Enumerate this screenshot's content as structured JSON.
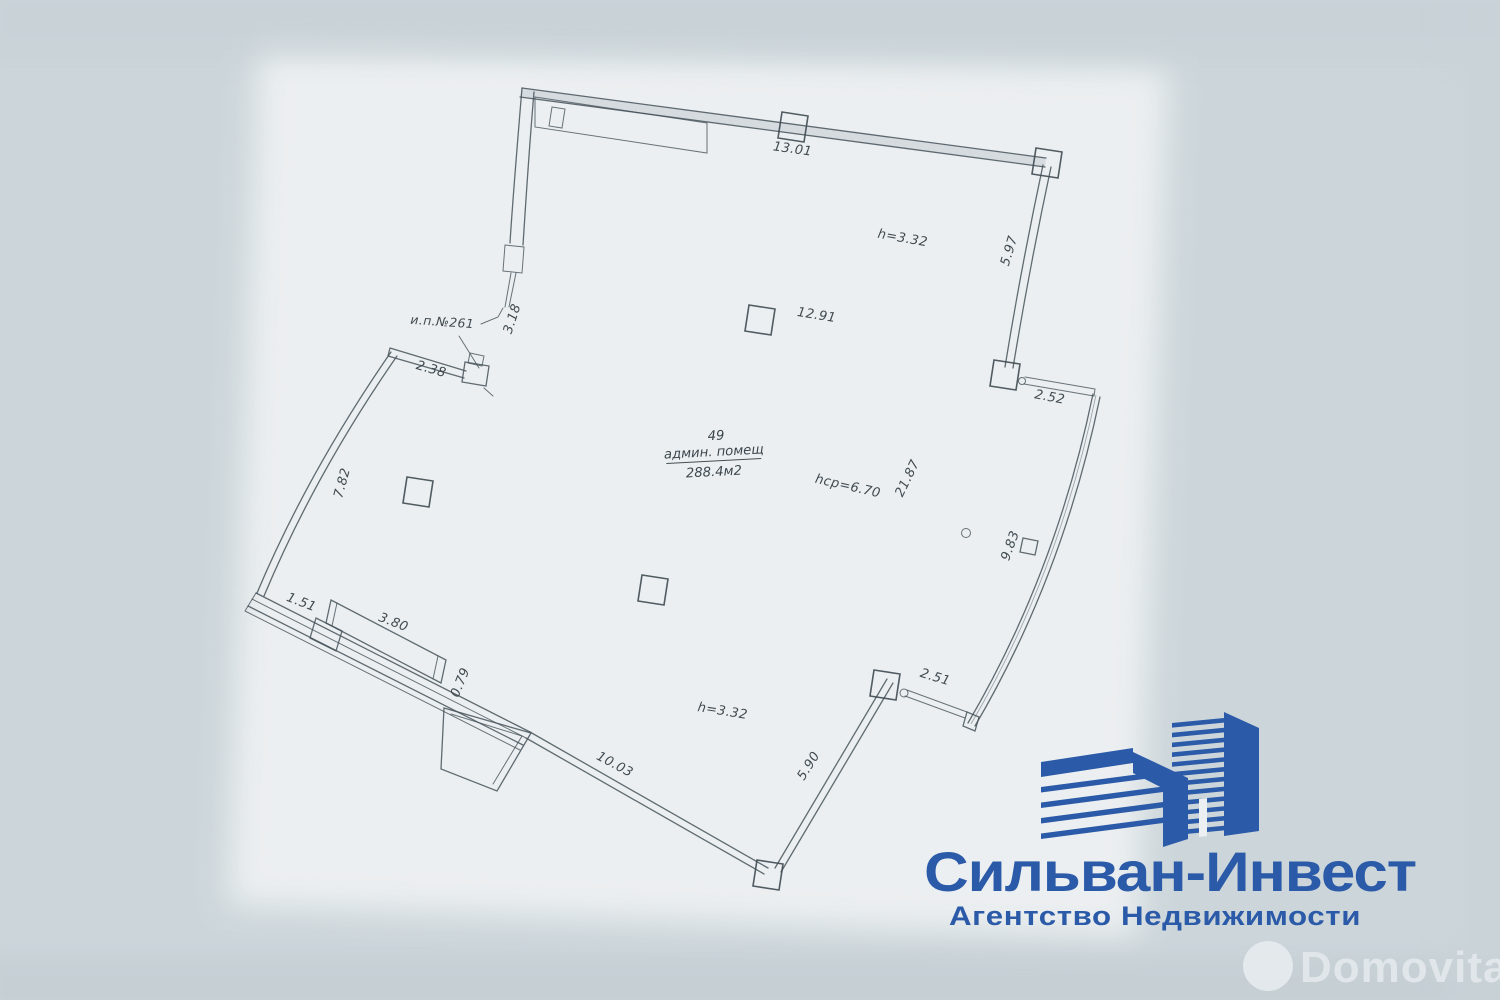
{
  "document_type": "floor-plan-photo",
  "colors": {
    "page_background": "#ccd6da",
    "paper": "#edf0f2",
    "ink": "#46525a",
    "brand_blue": "#2b5aa8",
    "watermark": "#e3e9ec"
  },
  "plan": {
    "unit_pointer": "и.п.№261",
    "room": {
      "number": "49",
      "type": "админ. помещ",
      "area": "288.4м2"
    },
    "dims": {
      "top_width": "13.01",
      "height_top": "h=3.32",
      "right_upper": "5.97",
      "interior_width": "12.91",
      "entry_depth": "3.18",
      "entry_width": "2.38",
      "right_step": "2.52",
      "left_height": "7.82",
      "east_total": "21.87",
      "height_avg": "hср=6.70",
      "east_glazing": "9.83",
      "sw_seg1": "1.51",
      "sw_seg2": "3.80",
      "sw_seg3": "0.79",
      "se_step": "2.51",
      "height_bottom": "h=3.32",
      "bottom_width": "10.03",
      "bottom_right": "5.90"
    }
  },
  "logo": {
    "title": "Сильван-Инвест",
    "subtitle": "Агентство Недвижимости"
  },
  "watermark": {
    "text": "Domovita"
  }
}
